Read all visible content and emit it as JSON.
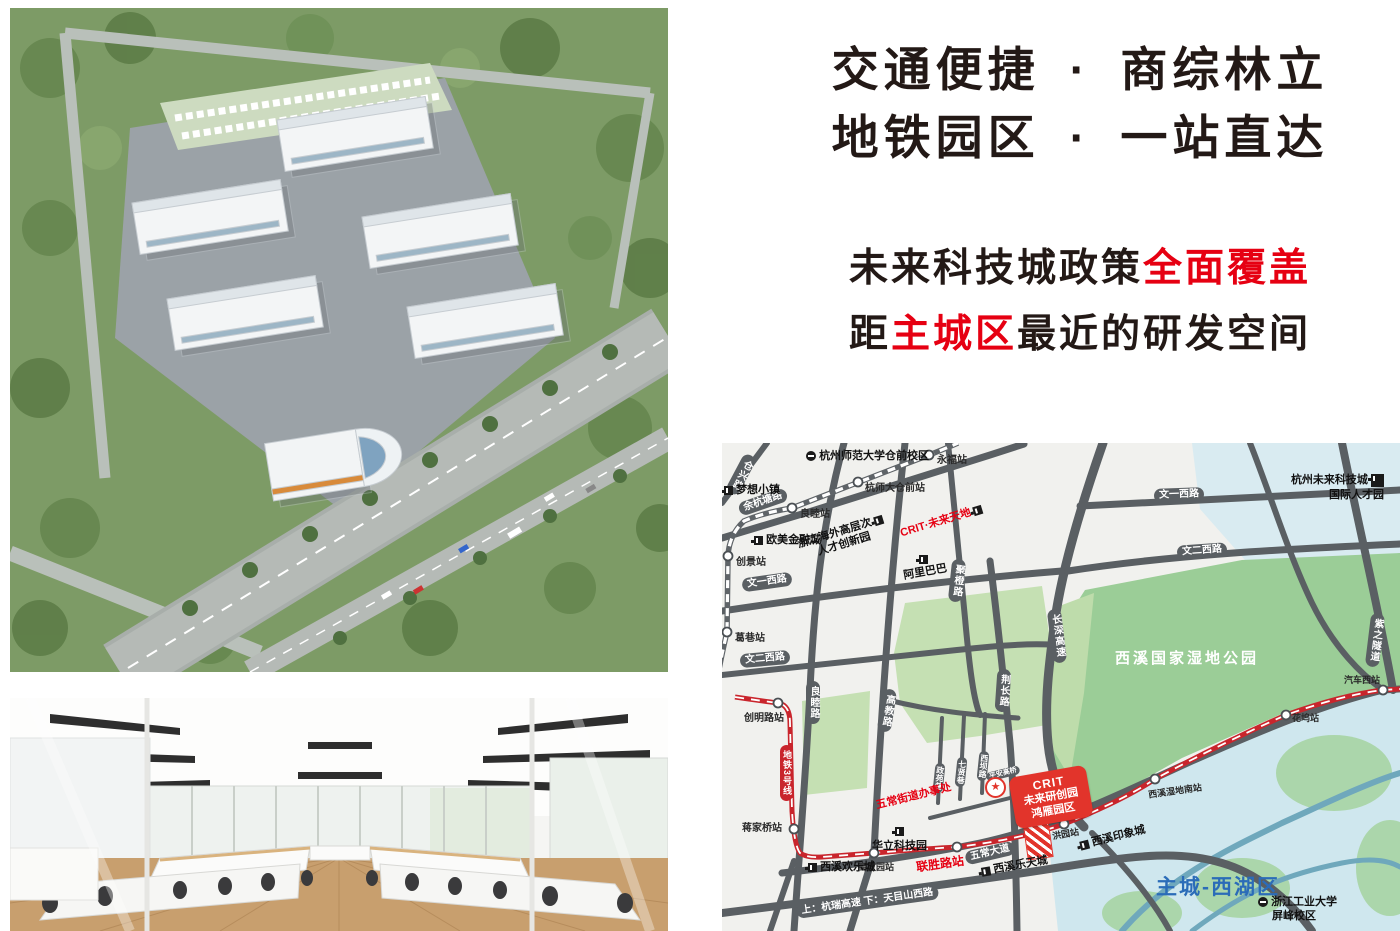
{
  "headline": {
    "line1_left": "交通便捷",
    "line1_dot": "·",
    "line1_right": "商综林立",
    "line2_left": "地铁园区",
    "line2_dot": "·",
    "line2_right": "一站直达",
    "body1_prefix": "未来科技城政策",
    "body1_highlight": "全面覆盖",
    "body2_prefix": "距",
    "body2_highlight": "主城区",
    "body2_suffix": "最近的研发空间",
    "accent_color": "#e60012"
  },
  "map": {
    "colors": {
      "metro_red": "#c9252c",
      "road_gray": "#5a5f63",
      "wetland_green": "#9bcd97",
      "water_blue": "#cfe7ee",
      "district_blue": "#2b6cb8",
      "banner_red": "#e2342b"
    },
    "roads": {
      "cangxing": "仓兴路",
      "yuhangtang": "余杭塘路",
      "wenyi_left": "文一西路",
      "wener_left": "文二西路",
      "wenyi_right": "文一西路",
      "wener_right": "文二西路",
      "liangmu": "良睦路",
      "gaojiao": "高教路",
      "jucheng": "聚橙路",
      "jingchang": "荆长路",
      "changshen": "长深高速",
      "zizhi": "紫之隧道",
      "wuchang": "五常大道",
      "zhengyuan": "政苑巷",
      "qixian": "七贤巷",
      "xiba": "西坝路",
      "pingan": "平安高桥",
      "bottom_highway": "上：杭瑞高速 下：天目山西路"
    },
    "metro": {
      "line3": "地铁3号线"
    },
    "stations": {
      "yongfu": "永福站",
      "hangshida": "杭师大仓前站",
      "liangmu": "良睦站",
      "chuangjing": "创景站",
      "gexiang": "葛巷站",
      "chuangming": "创明路站",
      "jiangjiaqiao": "蒋家桥站",
      "gaojiaoyuan": "高教园站",
      "liansheng": "联胜路站",
      "hongyuan": "洪园站",
      "shidinan": "西溪湿地南站",
      "huawu": "花坞站",
      "qichexi": "汽车西站"
    },
    "pois": {
      "hsd": "杭州师范大学仓前校区",
      "mengxiang": "梦想小镇",
      "oumei": "欧美金融城",
      "zhehai_l1": "浙江海外高层次",
      "zhehai_l2": "人才创新园",
      "crit_tiandi": "CRIT·未来天地",
      "alibaba": "阿里巴巴",
      "guoji_l1": "杭州未来科技城",
      "guoji_l2": "国际人才园",
      "huali": "华立科技园",
      "huanlecheng": "西溪欢乐城",
      "letiancheng": "西溪乐天城",
      "yinxiangcheng": "西溪印象城",
      "wuchang_office": "五常街道办事处",
      "zjut_l1": "浙江工业大学",
      "zjut_l2": "屏峰校区",
      "wetland": "西溪国家湿地公园",
      "district": "主城-西湖区",
      "star": "★"
    },
    "banner": {
      "l1": "CRIT",
      "l2": "未来研创园",
      "l3": "鸿雁园区"
    }
  }
}
